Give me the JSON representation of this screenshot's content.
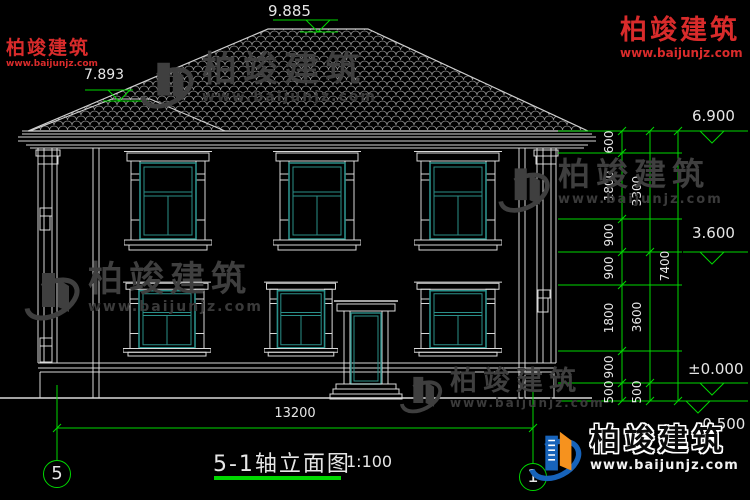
{
  "brand": {
    "name": "柏竣建筑",
    "url": "www.baijunjz.com"
  },
  "title": {
    "text": "5-1轴立面图",
    "scale": "1:100"
  },
  "axes": {
    "left": "5",
    "right": "1"
  },
  "elevations": {
    "ridge": "9.885",
    "lower_ridge": "7.893",
    "eave": "6.900",
    "second_floor": "3.600",
    "ground_floor": "±0.000",
    "outdoor_ground": "-0.500"
  },
  "dims": {
    "right_inner": [
      "600",
      "1800",
      "900",
      "900",
      "1800",
      "900",
      "500"
    ],
    "right_mid": [
      "3300",
      "3600",
      "500"
    ],
    "right_total": "7400",
    "bottom_width": "13200"
  }
}
